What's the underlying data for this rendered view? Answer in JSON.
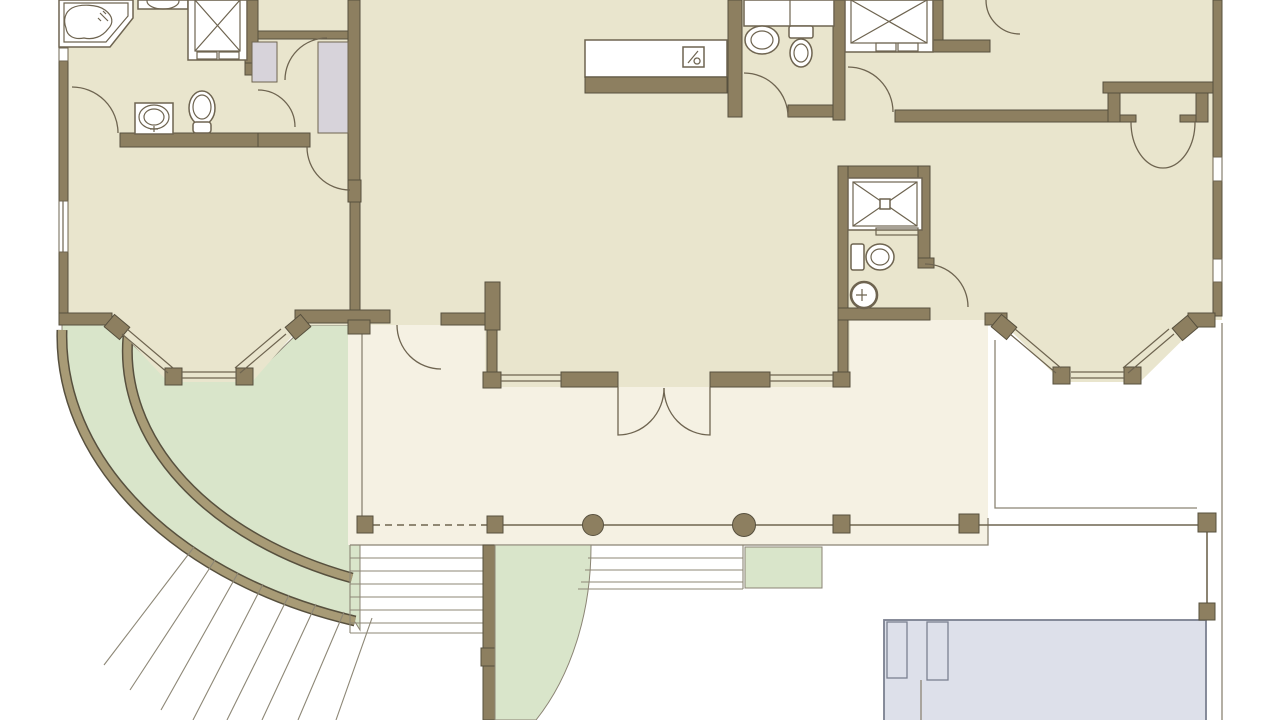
{
  "image_type": "architectural-floor-plan",
  "visible_text": [],
  "palette": {
    "bg": "#ffffff",
    "room": "#e9e5cd",
    "porch": "#f5f1e3",
    "green": "#d9e5ca",
    "wall": "#8d7f60",
    "wall_edge": "#57503e",
    "band": "#a89b76",
    "line": "#8b8474",
    "step": "#8d8776",
    "rail": "#6f6550",
    "fixline": "#6e6450",
    "closet": "#d7d3da",
    "pool": "#dde0ea",
    "pool_line": "#7b8090"
  },
  "areas": [
    "master-suite",
    "master-bathroom",
    "walk-in-closet",
    "great-room",
    "kitchen-island",
    "powder-room",
    "shower-room",
    "hall",
    "bedroom",
    "bathroom",
    "wardrobe-niche",
    "bay-window-left",
    "bay-window-right",
    "covered-porch",
    "terrace",
    "swimming-pool",
    "curved-garden",
    "steps"
  ],
  "fixtures": [
    "corner-bathtub",
    "shower-stall",
    "pedestal-sink",
    "toilet",
    "vanity-sink",
    "kitchen-island-sink",
    "round-sink",
    "closet-shelving",
    "railing-posts",
    "pool-steps"
  ]
}
